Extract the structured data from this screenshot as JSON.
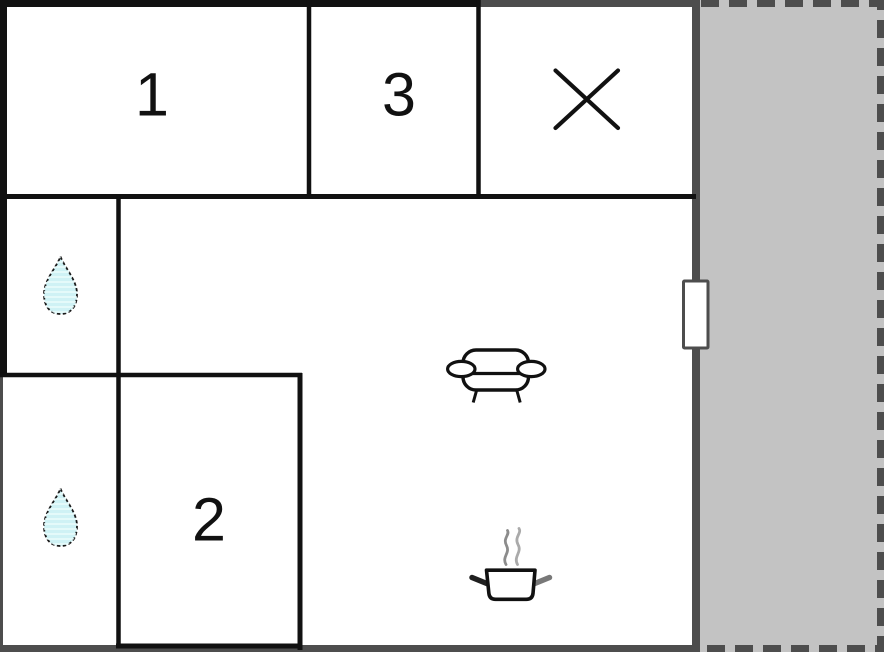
{
  "floorplan": {
    "rooms": [
      {
        "name": "room-1",
        "label": "1"
      },
      {
        "name": "room-2",
        "label": "2"
      },
      {
        "name": "room-3",
        "label": "3"
      }
    ],
    "icons": {
      "bathroom_upper": "water-drop-icon",
      "bathroom_lower": "water-drop-icon",
      "living_room": "sofa-icon",
      "kitchen": "cooking-pot-icon",
      "crossed_room": "x-cross-icon",
      "entrance": "door-icon"
    },
    "colors": {
      "wall_black": "#111111",
      "wall_gray": "#4d4d4d",
      "terrace_fill": "#c3c3c3",
      "drop_fill": "#cff2f5",
      "door_fill": "#ffffff",
      "steam_gray": "#8c8c8c"
    }
  }
}
